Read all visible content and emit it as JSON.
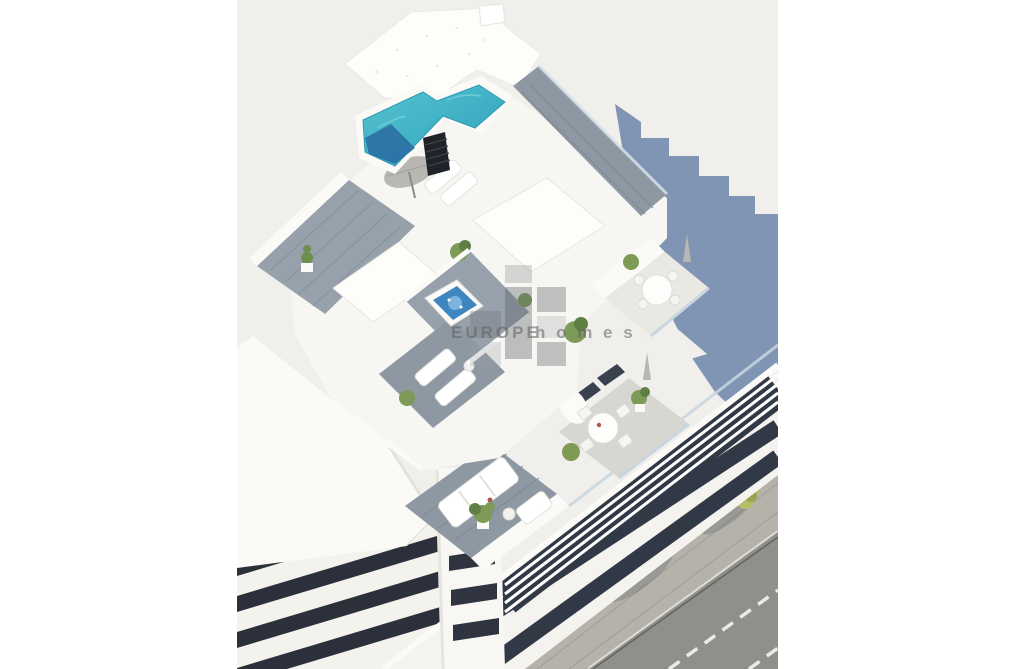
{
  "page": {
    "background": "#ffffff"
  },
  "photo": {
    "background": "#f0efec",
    "alt": "Aerial 3D architectural rendering of a white apartment building with rooftop pool, sun terraces, balconies and street",
    "watermark": {
      "brand_main": "EUROPE",
      "brand_sub": "h o m e s",
      "color": "#5f5f5f"
    },
    "colors": {
      "building_white": "#f7f6f2",
      "facade_base": "#f4f3ef",
      "wall_bright": "#fbfaf7",
      "roof_texture": "#fdfdfa",
      "deck_gray": "#97a1ac",
      "deck_gray_dark": "#8e98a3",
      "pool_teal_light": "#55c4cf",
      "pool_teal": "#2fa0bd",
      "pool_deep": "#2b6fa4",
      "jacuzzi_blue": "#3e86c0",
      "window_dark": "#323946",
      "slat_box": "#1f2227",
      "glass_rail": "#c9d6e0",
      "cast_shadow": "#8094b4",
      "asphalt": "#8f908b",
      "sidewalk": "#b4b2a9",
      "curb": "#dedcd5",
      "lane_marking": "#ebebe5",
      "tree_light": "#b6bc67",
      "tree_dark": "#9aa450",
      "plant_green": "#7d9b56",
      "plant_green_dark": "#5e8044",
      "neighbor_band": "#2b303a",
      "furniture_white": "#ffffff",
      "parasol_gray": "#b9b7b2"
    }
  }
}
